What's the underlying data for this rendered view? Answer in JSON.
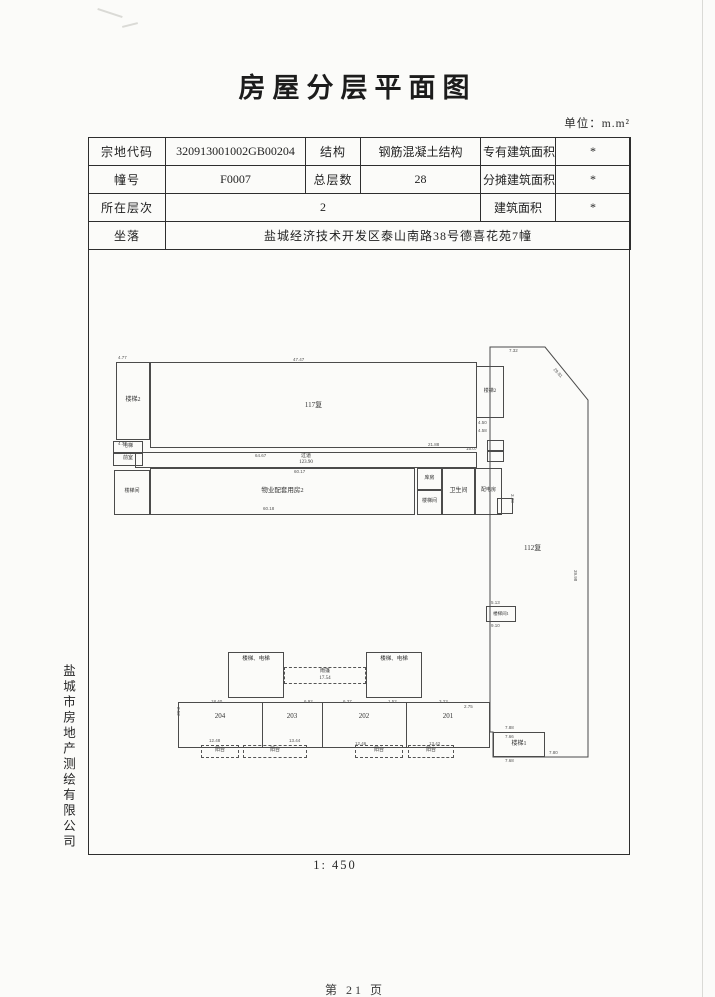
{
  "page": {
    "title": "房屋分层平面图",
    "unit_label": "单位：m.m²",
    "scale": "1: 450",
    "page_number": "第 21 页",
    "company_vertical": "盐城市房地产测绘有限公司"
  },
  "table": {
    "rows": [
      [
        "宗地代码",
        "320913001002GB00204",
        "结构",
        "钢筋混凝土结构",
        "专有建筑面积",
        "*"
      ],
      [
        "幢号",
        "F0007",
        "总层数",
        "28",
        "分摊建筑面积",
        "*"
      ],
      [
        "所在层次",
        "2",
        "建筑面积",
        "*"
      ],
      [
        "坐落",
        "盐城经济技术开发区泰山南路38号德喜花苑7幢"
      ]
    ]
  },
  "plan": {
    "rooms": [
      {
        "name": "stair-2-left",
        "label": "楼梯2",
        "x": 116,
        "y": 362,
        "w": 34,
        "h": 78,
        "fs": 6
      },
      {
        "name": "elevator-left",
        "label": "电梯",
        "x": 113,
        "y": 441,
        "w": 30,
        "h": 12,
        "fs": 5
      },
      {
        "name": "lobby-left",
        "label": "前室",
        "x": 113,
        "y": 453,
        "w": 30,
        "h": 13,
        "fs": 5
      },
      {
        "name": "stairwell-left",
        "label": "楼梯间",
        "x": 114,
        "y": 470,
        "w": 36,
        "h": 45,
        "fs": 5
      },
      {
        "name": "hall-117",
        "label": "117复",
        "x": 150,
        "y": 362,
        "w": 327,
        "h": 86,
        "fs": 7
      },
      {
        "name": "corridor",
        "label": "过道\n123.90",
        "x": 135,
        "y": 452,
        "w": 342,
        "h": 16,
        "fs": 5
      },
      {
        "name": "property-room",
        "label": "物业配套用房2",
        "x": 150,
        "y": 468,
        "w": 265,
        "h": 47,
        "fs": 6.5
      },
      {
        "name": "storage",
        "label": "库房",
        "x": 417,
        "y": 468,
        "w": 25,
        "h": 22,
        "fs": 5
      },
      {
        "name": "stairwell-mid",
        "label": "楼梯间",
        "x": 417,
        "y": 490,
        "w": 25,
        "h": 25,
        "fs": 5
      },
      {
        "name": "bathroom",
        "label": "卫生间",
        "x": 442,
        "y": 468,
        "w": 33,
        "h": 47,
        "fs": 6
      },
      {
        "name": "power-room",
        "label": "配电房",
        "x": 475,
        "y": 468,
        "w": 27,
        "h": 47,
        "fs": 5
      },
      {
        "name": "small-box-right",
        "label": "",
        "x": 497,
        "y": 498,
        "w": 16,
        "h": 16,
        "fs": 4
      },
      {
        "name": "stair-2-right",
        "label": "楼梯2",
        "x": 476,
        "y": 366,
        "w": 28,
        "h": 52,
        "fs": 5
      },
      {
        "name": "small-box-a",
        "label": "",
        "x": 487,
        "y": 440,
        "w": 17,
        "h": 11,
        "fs": 4
      },
      {
        "name": "small-box-b",
        "label": "",
        "x": 487,
        "y": 451,
        "w": 17,
        "h": 11,
        "fs": 4
      },
      {
        "name": "stairwell-1",
        "label": "楼梯间1",
        "x": 486,
        "y": 606,
        "w": 30,
        "h": 16,
        "fs": 4.5
      },
      {
        "name": "stair-1",
        "label": "楼梯1",
        "x": 493,
        "y": 732,
        "w": 52,
        "h": 25,
        "fs": 6
      },
      {
        "name": "stair-elev-left",
        "label": "楼梯、电梯",
        "x": 228,
        "y": 652,
        "w": 56,
        "h": 46,
        "fs": 5.5,
        "top": true
      },
      {
        "name": "stair-elev-right",
        "label": "楼梯、电梯",
        "x": 366,
        "y": 652,
        "w": 56,
        "h": 46,
        "fs": 5.5,
        "top": true
      },
      {
        "name": "canopy",
        "label": "雨篷\n17.54",
        "x": 284,
        "y": 667,
        "w": 82,
        "h": 17,
        "fs": 5,
        "dashed": true
      },
      {
        "name": "units-band",
        "label": "",
        "x": 178,
        "y": 702,
        "w": 312,
        "h": 46,
        "fs": 5
      },
      {
        "name": "balcony-1",
        "label": "阳台",
        "x": 201,
        "y": 745,
        "w": 38,
        "h": 13,
        "fs": 5,
        "dashed": true
      },
      {
        "name": "balcony-2",
        "label": "阳台",
        "x": 243,
        "y": 745,
        "w": 64,
        "h": 13,
        "fs": 5,
        "dashed": true
      },
      {
        "name": "balcony-3",
        "label": "阳台",
        "x": 355,
        "y": 745,
        "w": 48,
        "h": 13,
        "fs": 5,
        "dashed": true
      },
      {
        "name": "balcony-4",
        "label": "阳台",
        "x": 408,
        "y": 745,
        "w": 46,
        "h": 13,
        "fs": 5,
        "dashed": true
      }
    ],
    "unit_dividers": [
      262,
      322,
      406
    ],
    "unit_divider_y": 702,
    "unit_divider_h": 46,
    "unit_labels": [
      {
        "t": "204",
        "x": 220
      },
      {
        "t": "203",
        "x": 292
      },
      {
        "t": "202",
        "x": 364
      },
      {
        "t": "201",
        "x": 448
      }
    ],
    "unit_label_y": 712,
    "texts": [
      {
        "t": "112复",
        "x": 524,
        "y": 543,
        "fs": 7
      }
    ],
    "dims": [
      [
        "4.77",
        118,
        355,
        0
      ],
      [
        "4.77",
        118,
        441,
        0
      ],
      [
        "47.47",
        293,
        357,
        0
      ],
      [
        "21.88",
        428,
        442,
        0
      ],
      [
        "64.67",
        255,
        453,
        0
      ],
      [
        "60.17",
        294,
        469,
        0
      ],
      [
        "60.18",
        263,
        506,
        0
      ],
      [
        "7.32",
        509,
        348,
        0
      ],
      [
        "29.81",
        556,
        367,
        47
      ],
      [
        "15.07",
        466,
        446,
        0
      ],
      [
        "4.50",
        478,
        420,
        0
      ],
      [
        "4.58",
        478,
        428,
        0
      ],
      [
        "5.13",
        491,
        600,
        0
      ],
      [
        "9.10",
        491,
        623,
        0
      ],
      [
        "39.98",
        578,
        570,
        90
      ],
      [
        "7.88",
        505,
        725,
        0
      ],
      [
        "7.66",
        505,
        734,
        0
      ],
      [
        "7.68",
        505,
        758,
        0
      ],
      [
        "7.80",
        549,
        750,
        0
      ],
      [
        "18.40",
        211,
        699,
        0
      ],
      [
        "6.92",
        304,
        699,
        0
      ],
      [
        "6.37",
        343,
        699,
        0
      ],
      [
        "1.52",
        388,
        699,
        0
      ],
      [
        "3.23",
        439,
        699,
        0
      ],
      [
        "2.75",
        464,
        704,
        0
      ],
      [
        "2.52",
        181,
        707,
        90
      ],
      [
        "12.48",
        209,
        738,
        0
      ],
      [
        "13.44",
        289,
        738,
        0
      ],
      [
        "12.46",
        355,
        741,
        0
      ],
      [
        "13.42",
        429,
        741,
        0
      ],
      [
        "3.28",
        515,
        494,
        90
      ]
    ],
    "right_shape_points": "490,347 545,347 588,400 588,757 493,757 493,732 490,732"
  }
}
